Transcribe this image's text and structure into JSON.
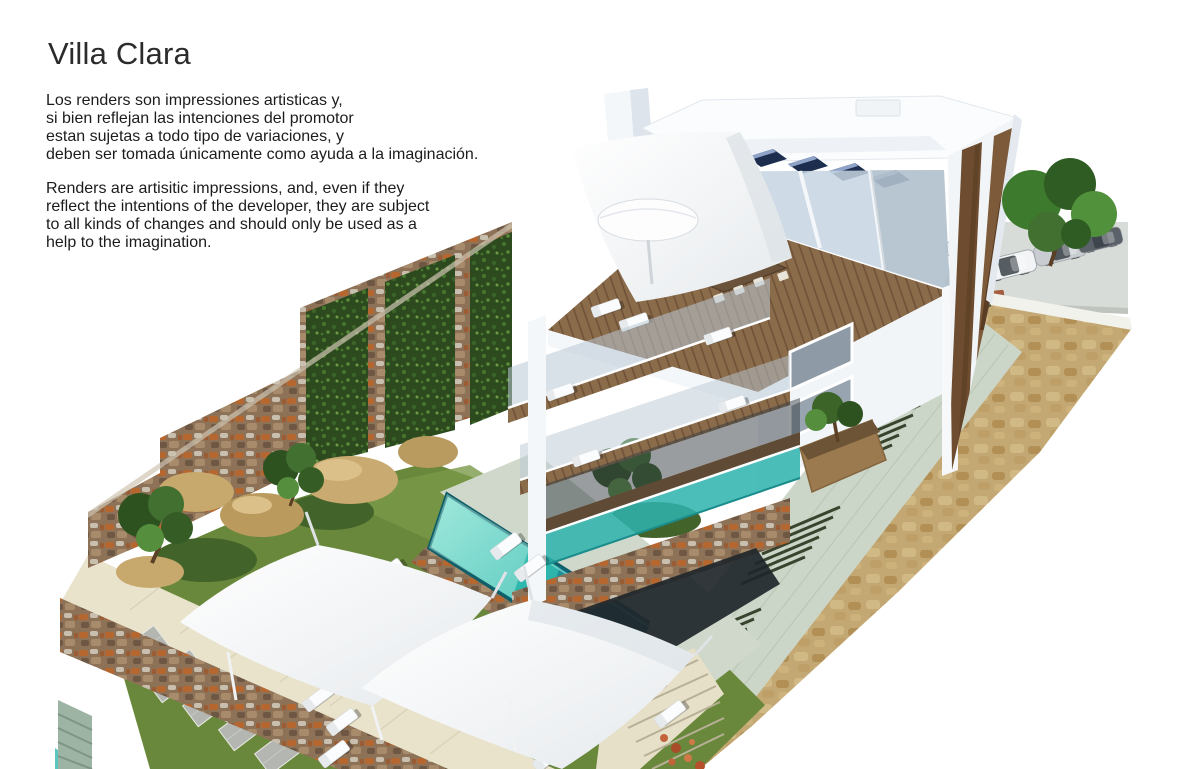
{
  "page_title": "Villa Clara",
  "disclaimer_es": {
    "lines": [
      "Los renders son impressiones artisticas y,",
      "si bien reflejan las intenciones del promotor",
      "estan sujetas a todo tipo de variaciones, y",
      "deben ser tomada únicamente como ayuda a la imaginación."
    ]
  },
  "disclaimer_en": {
    "lines": [
      "Renders are artisitic impressions, and, even if they",
      "reflect the intentions of the developer, they are subject",
      "to all kinds of changes and should only be used as a",
      "help to the imagination."
    ]
  },
  "render": {
    "alt": "Aerial 3D render of Villa Clara: modern white multi-storey villa with wooden deck terraces, rooftop solar panels, white shade sails and parasol, sun loungers, turquoise swimming pool, lawn, rustic stone retaining walls, vertical garden panels, stairs and street-level parking with cars and trees.",
    "palette": {
      "pool_water": "#2fb9ae",
      "grass": "#69883b",
      "wood_deck": "#8a6b4a",
      "stone_rust": "#8e7257",
      "stone_tan": "#ccb17b",
      "green_wall": "#2c4a1e",
      "building_white": "#f2f5f8",
      "facade_wood": "#6d4c2f",
      "solar_panel": "#1b2b4a",
      "glass_teal": "#2db3ae"
    }
  }
}
